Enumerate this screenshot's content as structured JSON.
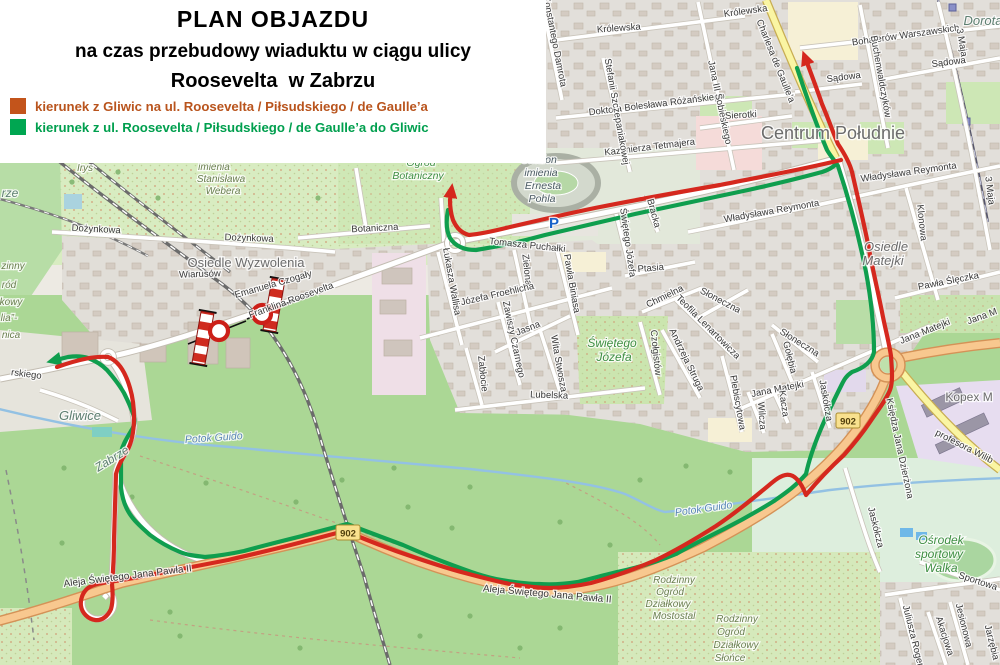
{
  "title": {
    "line1": "PLAN OBJAZDU",
    "line2": "na czas przebudowy wiaduktu w ciągu ulicy",
    "line3": "Roosevelta  w Zabrzu"
  },
  "legend": {
    "items": [
      {
        "label": "kierunek z Gliwic na ul. Roosevelta / Piłsudskiego / de Gaulle’a",
        "color": "#c3541b",
        "text_color": "#b9541d"
      },
      {
        "label": "kierunek z ul. Roosevelta / Piłsudskiego / de Gaulle’a do Gliwic",
        "color": "#00a651",
        "text_color": "#009f4e"
      }
    ]
  },
  "routes": {
    "red": {
      "name": "kierunek z Gliwic na ul. Roosevelta / Piłsudskiego / de Gaulle’a",
      "color": "#d5281e"
    },
    "green": {
      "name": "kierunek z ul. Roosevelta / Piłsudskiego / de Gaulle’a do Gliwic",
      "color": "#0f9e4e"
    }
  },
  "road_shields": [
    {
      "ref": "902",
      "x": 848,
      "y": 421
    },
    {
      "ref": "902",
      "x": 348,
      "y": 533
    }
  ],
  "map_labels": [
    {
      "t": "Irys",
      "x": 85,
      "y": 171,
      "c": "alot"
    },
    {
      "t": "imienia",
      "x": 214,
      "y": 170,
      "c": "alot"
    },
    {
      "t": "Stanisława",
      "x": 221,
      "y": 182,
      "c": "alot"
    },
    {
      "t": "Webera",
      "x": 223,
      "y": 194,
      "c": "alot"
    },
    {
      "t": "rze",
      "x": 10,
      "y": 197,
      "c": "city"
    },
    {
      "t": "Dożynkowa",
      "x": 96,
      "y": 232,
      "r": 3
    },
    {
      "t": "Dożynkowa",
      "x": 249,
      "y": 241,
      "r": 2
    },
    {
      "t": "Osiedle Wyzwolenia",
      "x": 246,
      "y": 267,
      "c": "dist"
    },
    {
      "t": "Wiarusów",
      "x": 200,
      "y": 277,
      "r": -2
    },
    {
      "t": "Emanuela Czogały",
      "x": 274,
      "y": 287,
      "r": -16
    },
    {
      "t": "Franklina Roosevelta",
      "x": 292,
      "y": 303,
      "r": -20
    },
    {
      "t": "rskiego",
      "x": 26,
      "y": 377,
      "r": 7
    },
    {
      "t": "Gliwice",
      "x": 80,
      "y": 420,
      "c": "city",
      "s": 13
    },
    {
      "t": "Zabrze",
      "x": 114,
      "y": 462,
      "r": -32,
      "c": "city"
    },
    {
      "t": "Potok Guido",
      "x": 214,
      "y": 441,
      "r": -4,
      "c": "wat"
    },
    {
      "t": "Potok Guido",
      "x": 704,
      "y": 512,
      "r": -8,
      "c": "wat"
    },
    {
      "t": "Ogród",
      "x": 421,
      "y": 166,
      "c": "grn"
    },
    {
      "t": "Botaniczny",
      "x": 418,
      "y": 179,
      "c": "grn"
    },
    {
      "t": "Stadion",
      "x": 539,
      "y": 163,
      "c": "stad"
    },
    {
      "t": "imienia",
      "x": 541,
      "y": 176,
      "c": "stad"
    },
    {
      "t": "Ernesta",
      "x": 543,
      "y": 189,
      "c": "stad"
    },
    {
      "t": "Pohla",
      "x": 542,
      "y": 202,
      "c": "stad"
    },
    {
      "t": "P",
      "x": 554,
      "y": 228,
      "c": "pkg"
    },
    {
      "t": "Botaniczna",
      "x": 375,
      "y": 231,
      "r": -3
    },
    {
      "t": "Tomasza Puchałki",
      "x": 527,
      "y": 248,
      "r": 6
    },
    {
      "t": "Łukasza Wallisa",
      "x": 449,
      "y": 282,
      "r": 80
    },
    {
      "t": "Zielona",
      "x": 524,
      "y": 270,
      "r": 84
    },
    {
      "t": "Pawła Biniasa",
      "x": 569,
      "y": 284,
      "r": 80
    },
    {
      "t": "Józefa Froehlicha",
      "x": 498,
      "y": 297,
      "r": -13
    },
    {
      "t": "Zawiszy Czarnego",
      "x": 511,
      "y": 340,
      "r": 78
    },
    {
      "t": "Jasna",
      "x": 529,
      "y": 331,
      "r": -22
    },
    {
      "t": "Zabłocie",
      "x": 480,
      "y": 374,
      "r": 84
    },
    {
      "t": "Wita Stwosza",
      "x": 556,
      "y": 364,
      "r": 80
    },
    {
      "t": "Świętego",
      "x": 612,
      "y": 347,
      "c": "grn",
      "s": 12
    },
    {
      "t": "Józefa",
      "x": 614,
      "y": 361,
      "c": "grn",
      "s": 12
    },
    {
      "t": "Lubelska",
      "x": 549,
      "y": 398,
      "r": 2
    },
    {
      "t": "Świętego Józefa",
      "x": 625,
      "y": 243,
      "r": 82
    },
    {
      "t": "Bracka",
      "x": 651,
      "y": 214,
      "r": 75
    },
    {
      "t": "Ptasia",
      "x": 651,
      "y": 271,
      "r": -5
    },
    {
      "t": "Chmielna",
      "x": 666,
      "y": 299,
      "r": -26
    },
    {
      "t": "Teofila Lenartowicza",
      "x": 706,
      "y": 329,
      "r": 45
    },
    {
      "t": "Słoneczna",
      "x": 719,
      "y": 303,
      "r": 28
    },
    {
      "t": "Słoneczna",
      "x": 798,
      "y": 345,
      "r": 32
    },
    {
      "t": "Czołgistów",
      "x": 653,
      "y": 353,
      "r": 84
    },
    {
      "t": "Andrzeja Struga",
      "x": 684,
      "y": 361,
      "r": 64
    },
    {
      "t": "Plebiscytowa",
      "x": 735,
      "y": 403,
      "r": 80
    },
    {
      "t": "Gołębia",
      "x": 787,
      "y": 358,
      "r": 76
    },
    {
      "t": "Jana Matejki",
      "x": 778,
      "y": 392,
      "r": -11
    },
    {
      "t": "Kacza",
      "x": 781,
      "y": 404,
      "r": 82
    },
    {
      "t": "Wilcza",
      "x": 759,
      "y": 416,
      "r": 86
    },
    {
      "t": "Jaskółcza",
      "x": 823,
      "y": 401,
      "r": 80
    },
    {
      "t": "Jaskółcza",
      "x": 873,
      "y": 528,
      "r": 76
    },
    {
      "t": "Królewska",
      "x": 619,
      "y": 31,
      "r": -4
    },
    {
      "t": "Królewska",
      "x": 746,
      "y": 14,
      "r": -8
    },
    {
      "t": "Charlesa de Gaulle’a",
      "x": 773,
      "y": 62,
      "r": 68
    },
    {
      "t": "Bohaterów Warszawskich",
      "x": 906,
      "y": 38,
      "r": -8
    },
    {
      "t": "Sądowa",
      "x": 844,
      "y": 80,
      "r": -7
    },
    {
      "t": "Sądowa",
      "x": 949,
      "y": 65,
      "r": -7
    },
    {
      "t": "Dorota",
      "x": 983,
      "y": 25,
      "c": "city",
      "s": 13
    },
    {
      "t": "3 Maja",
      "x": 959,
      "y": 43,
      "r": 80
    },
    {
      "t": "3 Maja",
      "x": 987,
      "y": 191,
      "r": 83
    },
    {
      "t": "Konstantego Damrota",
      "x": 552,
      "y": 42,
      "r": 79
    },
    {
      "t": "Doktora Bolesława Różańskiego",
      "x": 657,
      "y": 107,
      "r": -7
    },
    {
      "t": "Kazimierza Tetmajera",
      "x": 650,
      "y": 150,
      "r": -7
    },
    {
      "t": "Jana III Sobieskiego",
      "x": 717,
      "y": 103,
      "r": 78
    },
    {
      "t": "Stefanii Szczepaniakowej",
      "x": 614,
      "y": 112,
      "r": 80
    },
    {
      "t": "Sierotki",
      "x": 741,
      "y": 118,
      "r": -3
    },
    {
      "t": "Centrum Południe",
      "x": 833,
      "y": 139,
      "c": "dist",
      "s": 18
    },
    {
      "t": "Władysława Reymonta",
      "x": 909,
      "y": 175,
      "r": -8
    },
    {
      "t": "Władysława Reymonta",
      "x": 772,
      "y": 214,
      "r": -10
    },
    {
      "t": "Klonowa",
      "x": 919,
      "y": 223,
      "r": 84
    },
    {
      "t": "Osiedle",
      "x": 886,
      "y": 251,
      "c": "disti"
    },
    {
      "t": "Matejki",
      "x": 883,
      "y": 265,
      "c": "disti"
    },
    {
      "t": "Pawła Ślęczka",
      "x": 949,
      "y": 284,
      "r": -11
    },
    {
      "t": "Jana Matejki",
      "x": 926,
      "y": 334,
      "r": -22
    },
    {
      "t": "Jana M",
      "x": 983,
      "y": 319,
      "r": -20
    },
    {
      "t": "Kopex M",
      "x": 969,
      "y": 401,
      "c": "dist",
      "s": 12
    },
    {
      "t": "profesora Wilib",
      "x": 963,
      "y": 449,
      "r": 27
    },
    {
      "t": "Księdza Jana Dzierżona",
      "x": 897,
      "y": 449,
      "r": 78
    },
    {
      "t": "Buchenwaldczyków",
      "x": 878,
      "y": 77,
      "r": 80
    },
    {
      "t": "Aleja Świętego Jana Pawła II",
      "x": 128,
      "y": 579,
      "r": -7,
      "s": 10
    },
    {
      "t": "Aleja Świętego Jana Pawła II",
      "x": 547,
      "y": 597,
      "r": 5,
      "s": 10
    },
    {
      "t": "Rodzinny",
      "x": 674,
      "y": 583,
      "c": "alot"
    },
    {
      "t": "Ogród",
      "x": 670,
      "y": 595,
      "c": "alot"
    },
    {
      "t": "Działkowy",
      "x": 668,
      "y": 607,
      "c": "alot"
    },
    {
      "t": "Mostostal",
      "x": 674,
      "y": 619,
      "c": "alot"
    },
    {
      "t": "Rodzinny",
      "x": 737,
      "y": 622,
      "c": "alot"
    },
    {
      "t": "Ogród",
      "x": 731,
      "y": 635,
      "c": "alot"
    },
    {
      "t": "Działkowy",
      "x": 736,
      "y": 648,
      "c": "alot"
    },
    {
      "t": "Słońce",
      "x": 730,
      "y": 661,
      "c": "alot"
    },
    {
      "t": "Ośrodek",
      "x": 941,
      "y": 544,
      "c": "grn",
      "s": 12
    },
    {
      "t": "sportowy",
      "x": 939,
      "y": 558,
      "c": "grn",
      "s": 12
    },
    {
      "t": "Walka",
      "x": 941,
      "y": 572,
      "c": "grn",
      "s": 12
    },
    {
      "t": "Sportowa",
      "x": 977,
      "y": 584,
      "r": 18
    },
    {
      "t": "Juliusza Rogera",
      "x": 911,
      "y": 639,
      "r": 76
    },
    {
      "t": "Akacjowa",
      "x": 942,
      "y": 637,
      "r": 72
    },
    {
      "t": "Jesionowa",
      "x": 961,
      "y": 626,
      "r": 76
    },
    {
      "t": "Jarzębia",
      "x": 989,
      "y": 643,
      "r": 76
    },
    {
      "t": "zinny",
      "x": 13,
      "y": 269,
      "c": "alot"
    },
    {
      "t": "ród",
      "x": 9,
      "y": 288,
      "c": "alot"
    },
    {
      "t": "kowy",
      "x": 11,
      "y": 305,
      "c": "alot"
    },
    {
      "t": "lia”-",
      "x": 9,
      "y": 321,
      "c": "alot"
    },
    {
      "t": "nica",
      "x": 11,
      "y": 338,
      "c": "alot"
    }
  ]
}
